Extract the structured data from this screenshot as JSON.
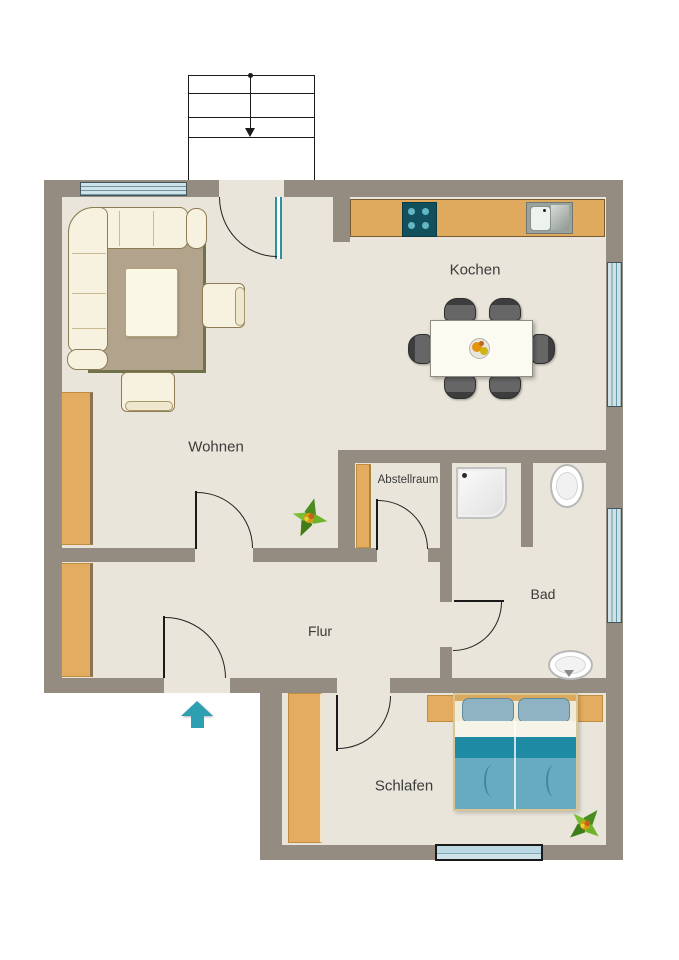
{
  "document": {
    "type": "apartment-floor-plan"
  },
  "rooms": {
    "kochen": {
      "label": "Kochen"
    },
    "wohnen": {
      "label": "Wohnen"
    },
    "abstellraum": {
      "label": "Abstellraum"
    },
    "bad": {
      "label": "Bad"
    },
    "flur": {
      "label": "Flur"
    },
    "schlafen": {
      "label": "Schlafen"
    }
  },
  "colors": {
    "wall": "#948c80",
    "floor": "#e9e5da",
    "wood": "#e3ac60",
    "rug": "#b2a48c",
    "upholstery": "#f7f2df",
    "bed_blanket_dark": "#1e8aa3",
    "bed_blanket": "#66abc0",
    "pillow": "#8fb3c2",
    "window_glass": "#cfe2e8",
    "entrance_arrow": "#2e9fb0",
    "label_text": "#3b3b3b"
  },
  "icons": {
    "entrance": "arrow-up-icon",
    "stairs_direction": "arrow-down-icon",
    "plants": "plant-icon"
  }
}
